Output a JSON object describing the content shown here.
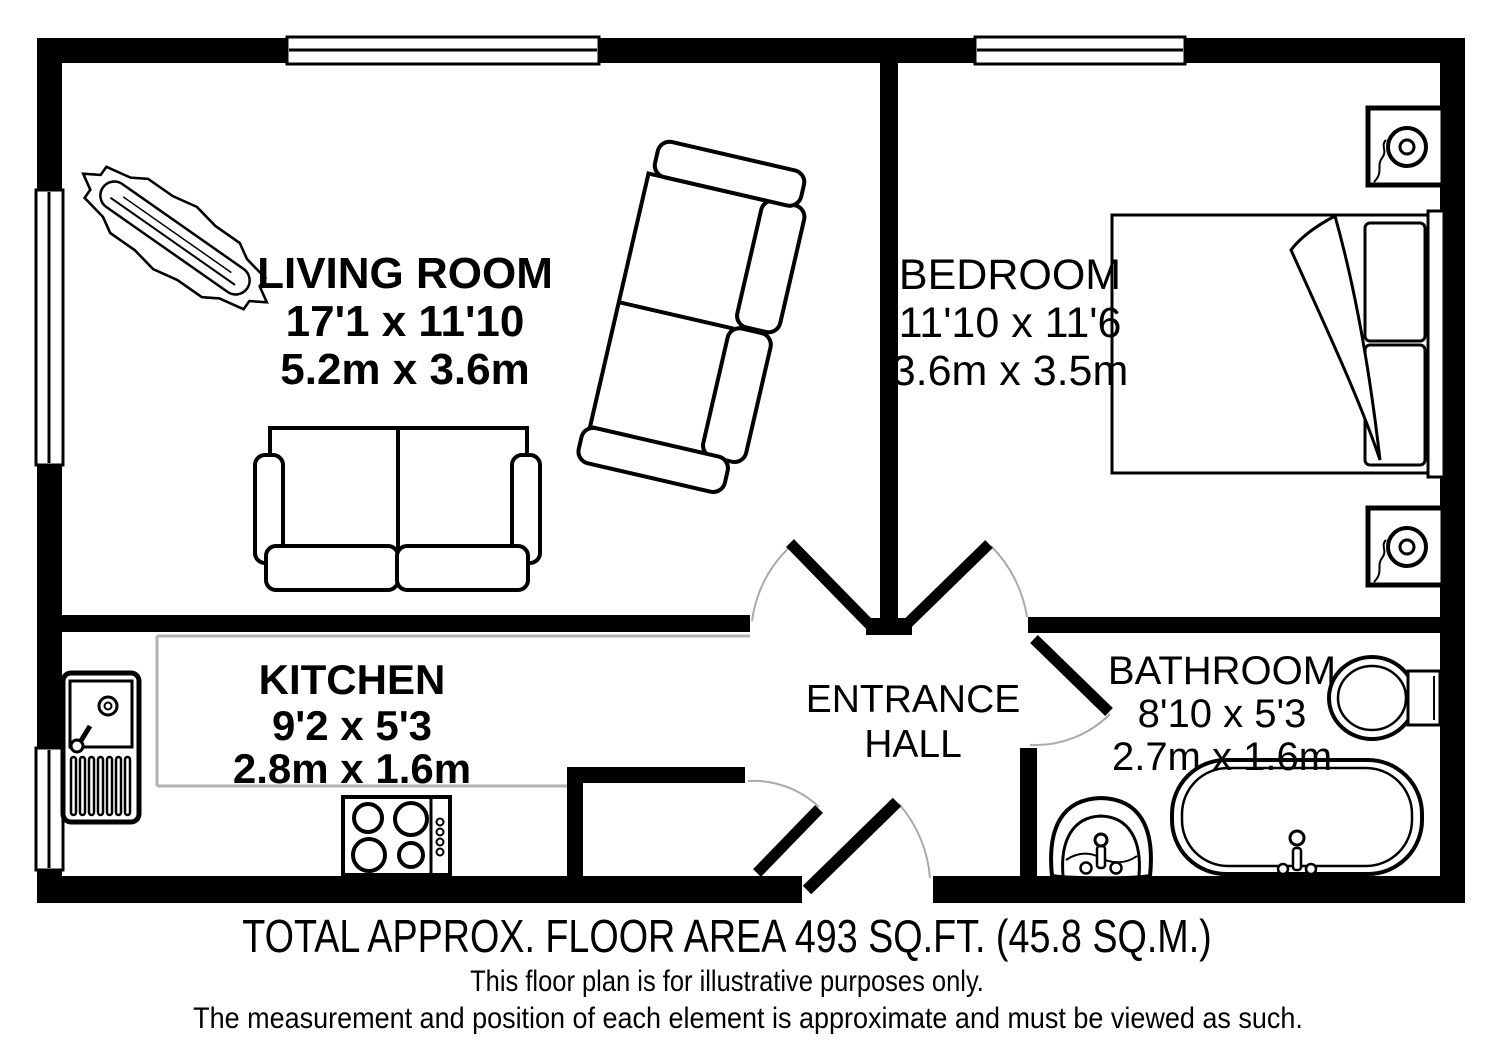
{
  "rooms": {
    "living_room": {
      "name": "LIVING ROOM",
      "imperial": "17'1 x 11'10",
      "metric": "5.2m x 3.6m"
    },
    "bedroom": {
      "name": "BEDROOM",
      "imperial": "11'10 x 11'6",
      "metric": "3.6m x 3.5m"
    },
    "kitchen": {
      "name": "KITCHEN",
      "imperial": "9'2 x 5'3",
      "metric": "2.8m x 1.6m"
    },
    "bathroom": {
      "name": "BATHROOM",
      "imperial": "8'10 x 5'3",
      "metric": "2.7m x 1.6m"
    },
    "entrance_hall": {
      "line1": "ENTRANCE",
      "line2": "HALL"
    }
  },
  "footer": {
    "total_area": "TOTAL APPROX. FLOOR AREA 493 SQ.FT. (45.8 SQ.M.)",
    "disclaimer_1": "This floor plan is for illustrative purposes only.",
    "disclaimer_2": "The measurement and position of each element is approximate and must be viewed as such."
  },
  "colors": {
    "wall": "#000000",
    "background": "#ffffff",
    "fixture_line": "#000000",
    "room_boundary": "#b3b3b3"
  }
}
